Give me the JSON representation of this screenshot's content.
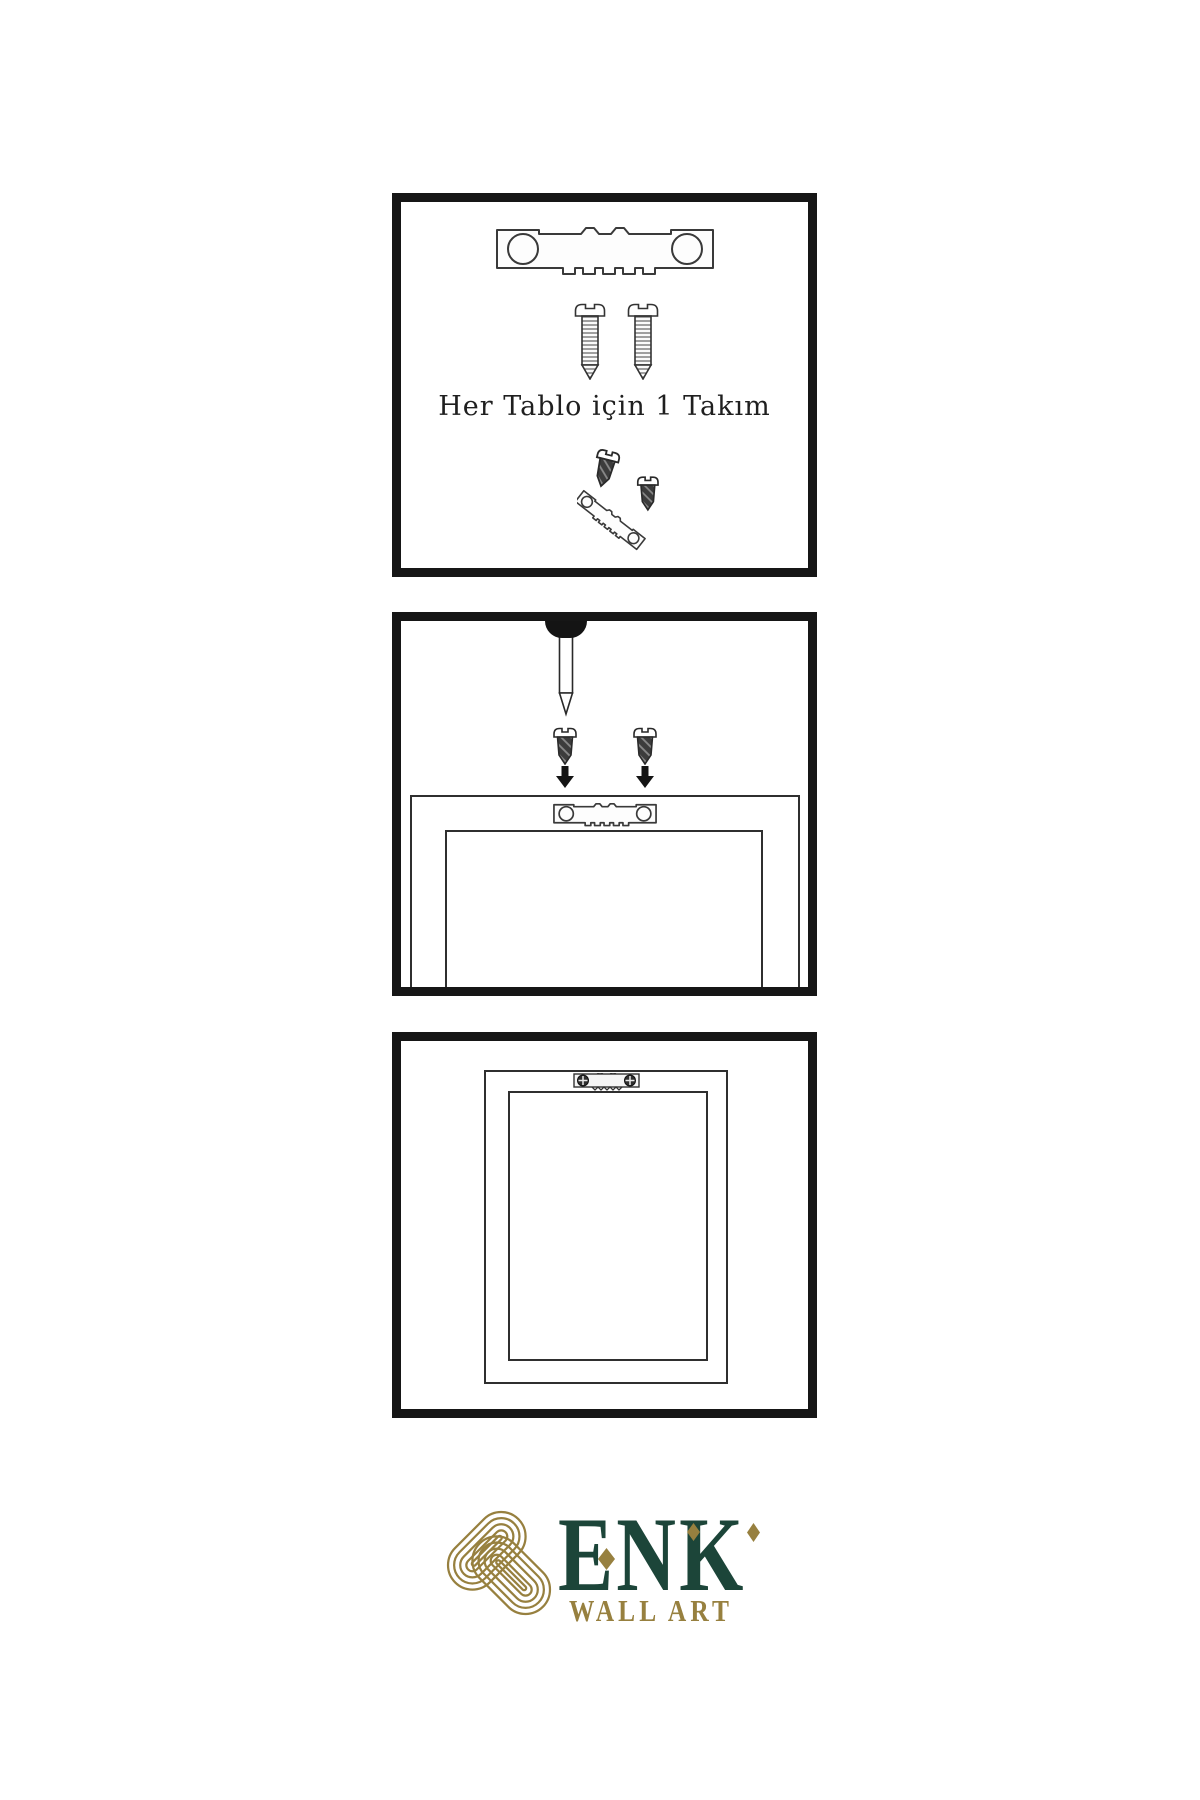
{
  "page": {
    "background": "#ffffff",
    "ink": "#1f1f1f",
    "panel_border": "#161616"
  },
  "panels": {
    "kit": {
      "caption": "Her Tablo için 1 Takım"
    },
    "mount": {},
    "hung": {}
  },
  "logo": {
    "brand": "ENK",
    "tagline": "WALL ART",
    "green": "#1c4539",
    "gold": "#97803f"
  },
  "icons": {
    "sawtooth-hanger": "serrated metal hanger plate with two screw holes",
    "wood-screw": "threaded screw with slotted pan head",
    "dark-screw": "short dark screw with slotted head",
    "down-arrow": "solid black arrow pointing down",
    "wall-nail": "long nail driven into wall plug",
    "phillips-screw-head": "round screw head with cross slot",
    "knot-logo": "gold interlaced celtic knot"
  }
}
